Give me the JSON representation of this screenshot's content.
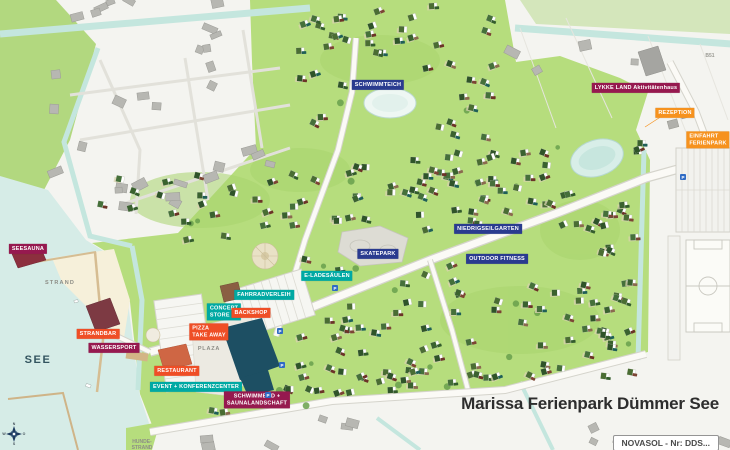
{
  "title": {
    "text": "Marissa Ferienpark Dümmer See",
    "badge": "NOVASOL - Nr: DDS..."
  },
  "map": {
    "poi_labels": [
      {
        "id": "seesauna",
        "text": "SEESAUNA",
        "type": "wellness",
        "x": 28,
        "y": 249
      },
      {
        "id": "strandbar",
        "text": "STRANDBAR",
        "type": "food",
        "x": 98,
        "y": 334
      },
      {
        "id": "wassersport",
        "text": "WASSERSPORT",
        "type": "wellness",
        "x": 114,
        "y": 348
      },
      {
        "id": "restaurant",
        "text": "RESTAURANT",
        "type": "food",
        "x": 177,
        "y": 371
      },
      {
        "id": "event-konferenzcenter",
        "text": "EVENT + KONFERENZCENTER",
        "type": "service",
        "x": 196,
        "y": 387
      },
      {
        "id": "schwimmbad-saunalandschaft",
        "text": "SCHWIMMBAD +\nSAUNALANDSCHAFT",
        "type": "wellness",
        "x": 257,
        "y": 400
      },
      {
        "id": "pizza-take-away",
        "text": "PIZZA\nTAKE AWAY",
        "type": "food",
        "x": 209,
        "y": 332,
        "align": "left"
      },
      {
        "id": "concept-store",
        "text": "CONCEPT\nSTORE",
        "type": "service",
        "x": 224,
        "y": 312,
        "align": "left"
      },
      {
        "id": "backshop",
        "text": "BACKSHOP",
        "type": "food",
        "x": 251,
        "y": 313
      },
      {
        "id": "fahrradverleih",
        "text": "FAHRRADVERLEIH",
        "type": "service",
        "x": 264,
        "y": 295
      },
      {
        "id": "e-ladesaeulen",
        "text": "E-LADESÄULEN",
        "type": "service",
        "x": 327,
        "y": 276
      },
      {
        "id": "skatepark",
        "text": "SKATEPARK",
        "type": "activity",
        "x": 378,
        "y": 254
      },
      {
        "id": "schwimmteich",
        "text": "SCHWIMMTEICH",
        "type": "activity",
        "x": 378,
        "y": 85
      },
      {
        "id": "niedrigseilgarten",
        "text": "NIEDRIGSEILGARTEN",
        "type": "activity",
        "x": 488,
        "y": 229
      },
      {
        "id": "outdoor-fitness",
        "text": "OUTDOOR FITNESS",
        "type": "activity",
        "x": 497,
        "y": 259
      },
      {
        "id": "lykke-land-aktivitaetenhaus",
        "text": "LYKKE LAND Aktivitätenhaus",
        "type": "wellness",
        "x": 636,
        "y": 88
      },
      {
        "id": "rezeption",
        "text": "REZEPTION",
        "type": "entrance",
        "x": 675,
        "y": 113
      },
      {
        "id": "einfahrt-ferienpark",
        "text": "EINFAHRT\nFERIENPARK",
        "type": "entrance",
        "x": 708,
        "y": 140,
        "align": "left"
      }
    ],
    "area_texts": [
      {
        "id": "see",
        "text": "SEE",
        "x": 38,
        "y": 360
      },
      {
        "id": "strand",
        "text": "STRAND",
        "x": 60,
        "y": 283
      },
      {
        "id": "plaza",
        "text": "PLAZA",
        "x": 209,
        "y": 349
      },
      {
        "id": "hunde-strand",
        "text": "HUNDE-\nSTRAND",
        "x": 142,
        "y": 445
      },
      {
        "id": "b51",
        "text": "B51",
        "x": 710,
        "y": 56
      }
    ],
    "parking_symbol": "P",
    "compass_points": [
      "N",
      "O",
      "S",
      "W"
    ],
    "colors": {
      "activity": "#2a3b8f",
      "service": "#00a9a3",
      "food": "#ef4e26",
      "wellness": "#96194f",
      "entrance": "#f6921e",
      "park_green": "#b6dd7d",
      "water": "#d6ece7"
    }
  }
}
